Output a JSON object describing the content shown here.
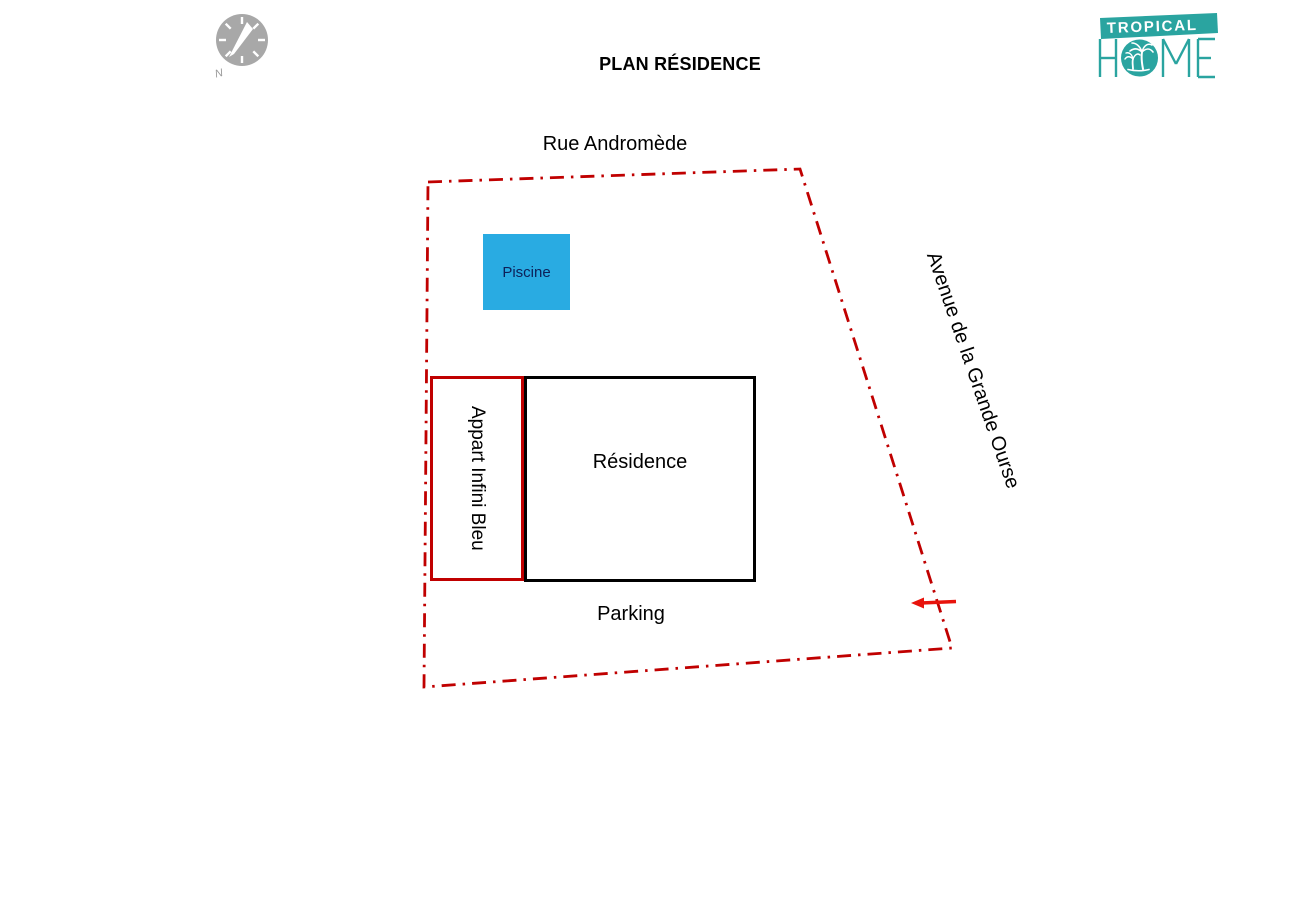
{
  "header": {
    "title": "PLAN RÉSIDENCE"
  },
  "logo": {
    "banner_text": "TROPICAL",
    "home_left": "H",
    "home_right": "ME",
    "brand_color": "#2AA4A0"
  },
  "compass": {
    "north_label": "N",
    "color": "#A8A8A8"
  },
  "streets": {
    "top": "Rue Andromède",
    "right": "Avenue de la Grande Ourse"
  },
  "areas": {
    "pool": {
      "label": "Piscine",
      "fill": "#29ABE2",
      "text_color": "#0D2058"
    },
    "apartment": {
      "label": "Appart Infini Bleu",
      "border_color": "#C00000"
    },
    "residence": {
      "label": "Résidence",
      "border_color": "#000000"
    },
    "parking": {
      "label": "Parking"
    }
  },
  "boundary": {
    "color": "#C00000",
    "style": "dash-dot"
  },
  "entrance_arrow": {
    "color": "#E8130C",
    "direction": "left"
  }
}
